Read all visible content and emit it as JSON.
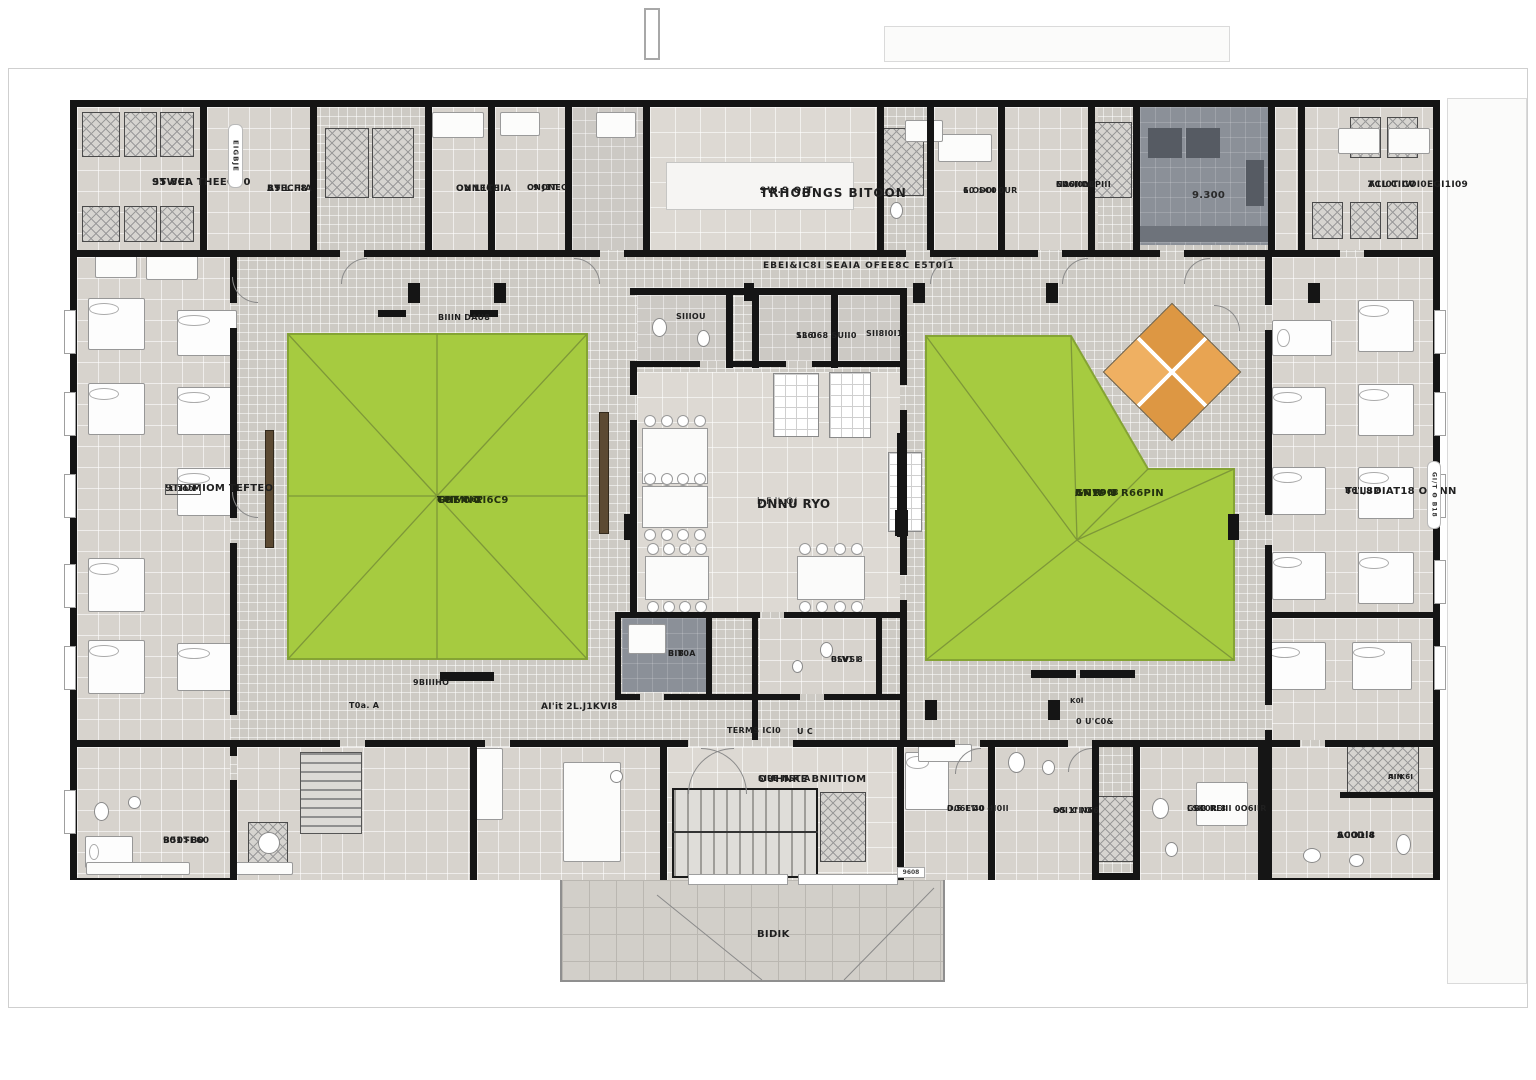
{
  "labels": {
    "storage_l1": "STWEA THEEOI 0",
    "storage_l2": "95 8CI",
    "eigbje": "EIGBJE",
    "brecina_l1": "BTECIIIA",
    "brecina_l2": "A9 L.F8",
    "onnecina_l1": "ONNECIIIA",
    "onnecina_l2": "OV L1T8",
    "onone_l1": "ONONEC",
    "onone_l2": "C9 J1T",
    "lounge_l1": "TRHOBNGS BITOON",
    "lounge_l2": "9W.S Θ/T",
    "laundry_l1": "1.OD0I 0UR",
    "laundry_l2": "60 >C0",
    "masterbath_l1": "EII6I0L8",
    "masterbath_l2": "NA0I OCPIII",
    "masterbath_l3": "CO '/IIV",
    "kitchen_num": "9.300",
    "suite_ne_l1": "A1I0T COI0EGI1I09",
    "suite_ne_l2": "TCL CIIW",
    "corridor_top": "EBEI&IC8I SEAIA OFEE8C E5T0I1",
    "bench_top": "BIIIN DAU8",
    "ward_left_l1": "9TIUMIOM TEFTEO",
    "ward_left_l2": "1.1Θ0I",
    "court_left_l1": "GNMNG",
    "court_left_l2": "TOE'0 XI6C9",
    "court_left_l3": "TO'Y/6.6P",
    "bath_small": "SIIIOU",
    "suite_small_l1": "SL6I68 SUII0",
    "suite_small_l2": "13 0",
    "shower_small": "SII8I0I1",
    "dining_l1": "DNNU RYO",
    "dining_l2": "b.F lL.Q/",
    "court_right_l1": "GNW N",
    "court_right_l2": "AN19 8 R66PIN",
    "court_right_l3": "B/C N0C8",
    "ward_right_l1": "T1L8DIAT18 OBINN",
    "ward_right_l2": "B6'.J9 8",
    "side_note_right": "GI/T Θ B18",
    "pantry_l1": "BIT0A",
    "pantry_l2": "B.B",
    "mid_bed_l1": "0SVSI",
    "mid_bed_l2": "BLV1 8",
    "sw_bench": "9BIIIHO",
    "sw_toa": "T0a. A",
    "sw_main": "AI'it 2L.J1KVI8",
    "se_k": "K0l",
    "se_u": "0 U'C0&",
    "entrance_l1": "OUHNKE BNIITIOM",
    "entrance_l2": "SI9E NST A",
    "entry_corr_l1": "TERMS ICI0",
    "entry_corr_l2": "U C",
    "bed_s1_l1": "D06ED0 dI0Il",
    "bed_s1_l2": "0.5 L'40",
    "bed_s2_l1": "S0I1I N66",
    "bed_s2_l2": "OS X'I/O",
    "bath_s_l1": "GBB REIII 0O6IIR",
    "bath_s_l2": "LSK0R 8",
    "bed_se_l1": "SC0DI4",
    "bed_se_l2": "A0O1l8",
    "closet_l1": "IIIN",
    "closet_l2": "AIIK6I",
    "bed_sw_l1": "B50TE60",
    "bed_sw_l2": "901>B0",
    "deck": "BIDIK",
    "deck_tag": "9608"
  },
  "colors": {
    "courtyard": "#a6cb40",
    "courtyard_edge": "#85a434",
    "courtyard_line": "#7e9838",
    "parasol": "#e8a452",
    "wall": "#151515"
  }
}
